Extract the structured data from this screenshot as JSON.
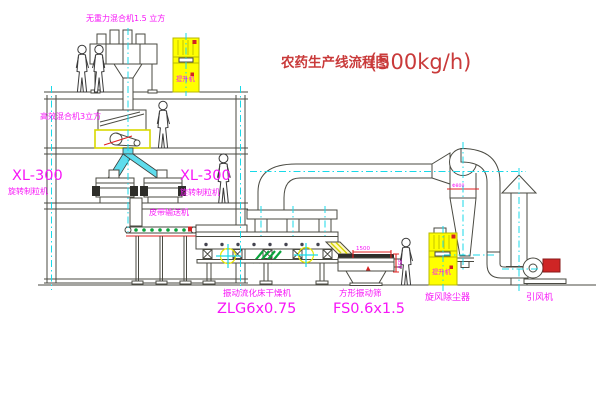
{
  "title": {
    "text": "农药生产线流程图",
    "capacity": "(500kg/h)"
  },
  "equipment": {
    "gravity_mixer": {
      "label": "无重力混合机1.5 立方"
    },
    "high_eff_mixer": {
      "label": "高效混合机3立方"
    },
    "elevator_top": {
      "name": "提升机"
    },
    "granulator_left": {
      "model": "XL-300",
      "name": "旋转制粒机"
    },
    "granulator_right": {
      "model": "XL-300",
      "name": "旋转制粒机"
    },
    "belt_conveyor": {
      "name": "皮带输送机"
    },
    "fluid_bed_dryer": {
      "name": "振动流化床干燥机",
      "model": "ZLG6x0.75"
    },
    "square_sieve": {
      "name": "方形振动筛",
      "model": "FS0.6x1.5",
      "dims": {
        "length": "1500",
        "height": "350"
      }
    },
    "cyclone": {
      "name": "旋风除尘器",
      "size": "Φ800"
    },
    "elevator_right": {
      "name": "提升机"
    },
    "fan": {
      "name": "引风机"
    }
  },
  "colors": {
    "line": "#4a4a42",
    "label": "#f716f7",
    "title": "#c93a3a",
    "centerline": "#18d9e8",
    "highlight": "#ffff00",
    "accent_red": "#e02222",
    "accent_green": "#0aa33c"
  }
}
